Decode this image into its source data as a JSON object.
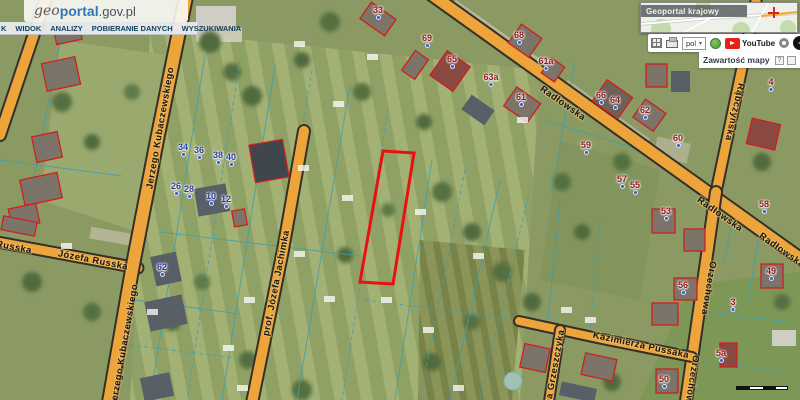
{
  "header": {
    "logo": {
      "geo": "geo",
      "portal": "portal",
      "domain": ".gov.pl"
    },
    "menu_items": [
      {
        "label": "K"
      },
      {
        "label": "WIDOK"
      },
      {
        "label": "ANALIZY"
      },
      {
        "label": "POBIERANIE DANYCH"
      },
      {
        "label": "WYSZUKIWANIA"
      }
    ]
  },
  "overview_panel": {
    "title": "Geoportal krajowy"
  },
  "toolbar": {
    "language_value": "pol",
    "youtube_label": "YouTube",
    "contrast_plus": "+"
  },
  "layers_panel": {
    "title": "Zawartość mapy",
    "help_glyph": "?"
  },
  "map": {
    "streets": [
      {
        "name": "Radłowska"
      },
      {
        "name": "Radłowska"
      },
      {
        "name": "Radłowska"
      },
      {
        "name": "Rąbczyńska"
      },
      {
        "name": "Orzechowa"
      },
      {
        "name": "Orzechowa"
      },
      {
        "name": "Kazimierza Pussaka"
      },
      {
        "name": "ana Grzeszczyka"
      },
      {
        "name": "prof. Józefa Jachimka"
      },
      {
        "name": "Jerzego Kubaczewskiego"
      },
      {
        "name": "Jerzego Kubaczewskiego"
      },
      {
        "name": "Józefa Russka"
      },
      {
        "name": "Russka"
      }
    ],
    "address_labels": [
      {
        "text": "33",
        "color": "red"
      },
      {
        "text": "69",
        "color": "red"
      },
      {
        "text": "68",
        "color": "red"
      },
      {
        "text": "65",
        "color": "red"
      },
      {
        "text": "63a",
        "color": "red"
      },
      {
        "text": "61",
        "color": "red"
      },
      {
        "text": "61a",
        "color": "red"
      },
      {
        "text": "66",
        "color": "red"
      },
      {
        "text": "64",
        "color": "red"
      },
      {
        "text": "62",
        "color": "red"
      },
      {
        "text": "60",
        "color": "red"
      },
      {
        "text": "59",
        "color": "red"
      },
      {
        "text": "57",
        "color": "red"
      },
      {
        "text": "55",
        "color": "red"
      },
      {
        "text": "53",
        "color": "red"
      },
      {
        "text": "58",
        "color": "red"
      },
      {
        "text": "4",
        "color": "red"
      },
      {
        "text": "49",
        "color": "red"
      },
      {
        "text": "3",
        "color": "red"
      },
      {
        "text": "56",
        "color": "red"
      },
      {
        "text": "5a",
        "color": "red"
      },
      {
        "text": "50",
        "color": "red"
      },
      {
        "text": "34",
        "color": "blue"
      },
      {
        "text": "36",
        "color": "blue"
      },
      {
        "text": "38",
        "color": "blue"
      },
      {
        "text": "40",
        "color": "blue"
      },
      {
        "text": "26",
        "color": "blue"
      },
      {
        "text": "28",
        "color": "blue"
      },
      {
        "text": "10",
        "color": "blue"
      },
      {
        "text": "12",
        "color": "blue"
      },
      {
        "text": "62",
        "color": "blue"
      }
    ],
    "colors": {
      "road_fill": "#eda53b",
      "road_casing": "#33302a",
      "parcel_line": "#3f9fae",
      "building_outline": "#cf1f1f",
      "selection": "#e81010"
    }
  }
}
